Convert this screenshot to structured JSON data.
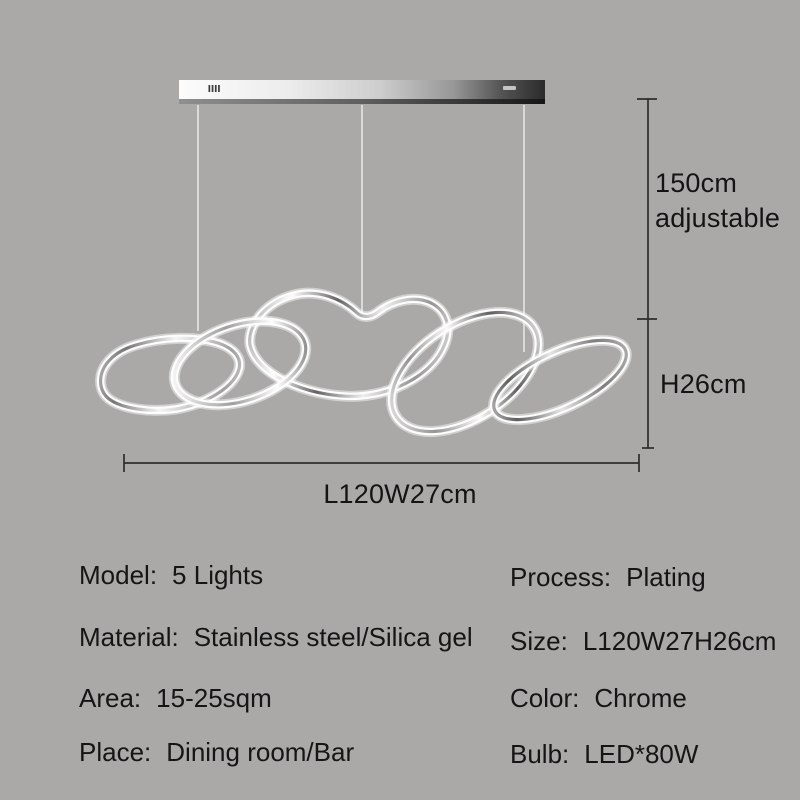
{
  "colors": {
    "background": "#aaa9a8",
    "dimension_line": "#2e2e2e",
    "text": "#151515",
    "chrome_light": "#ffffff",
    "chrome_dark": "#4f4f4f"
  },
  "annotations": {
    "drop_length": {
      "line1": "150cm",
      "line2": "adjustable"
    },
    "fixture_height": "H26cm",
    "fixture_length": "L120W27cm"
  },
  "specs": {
    "left": [
      {
        "label": "Model:",
        "value": "5 Lights"
      },
      {
        "label": "Material:",
        "value": "Stainless steel/Silica gel"
      },
      {
        "label": "Area:",
        "value": "15-25sqm"
      },
      {
        "label": "Place:",
        "value": "Dining room/Bar"
      }
    ],
    "right": [
      {
        "label": "Process:",
        "value": "Plating"
      },
      {
        "label": "Size:",
        "value": "L120W27H26cm"
      },
      {
        "label": "Color:",
        "value": "Chrome"
      },
      {
        "label": "Bulb:",
        "value": "LED*80W"
      }
    ]
  },
  "icons": {
    "canopy_vent": "canopy-vent-marks",
    "canopy_brand": "canopy-brand-mark"
  }
}
